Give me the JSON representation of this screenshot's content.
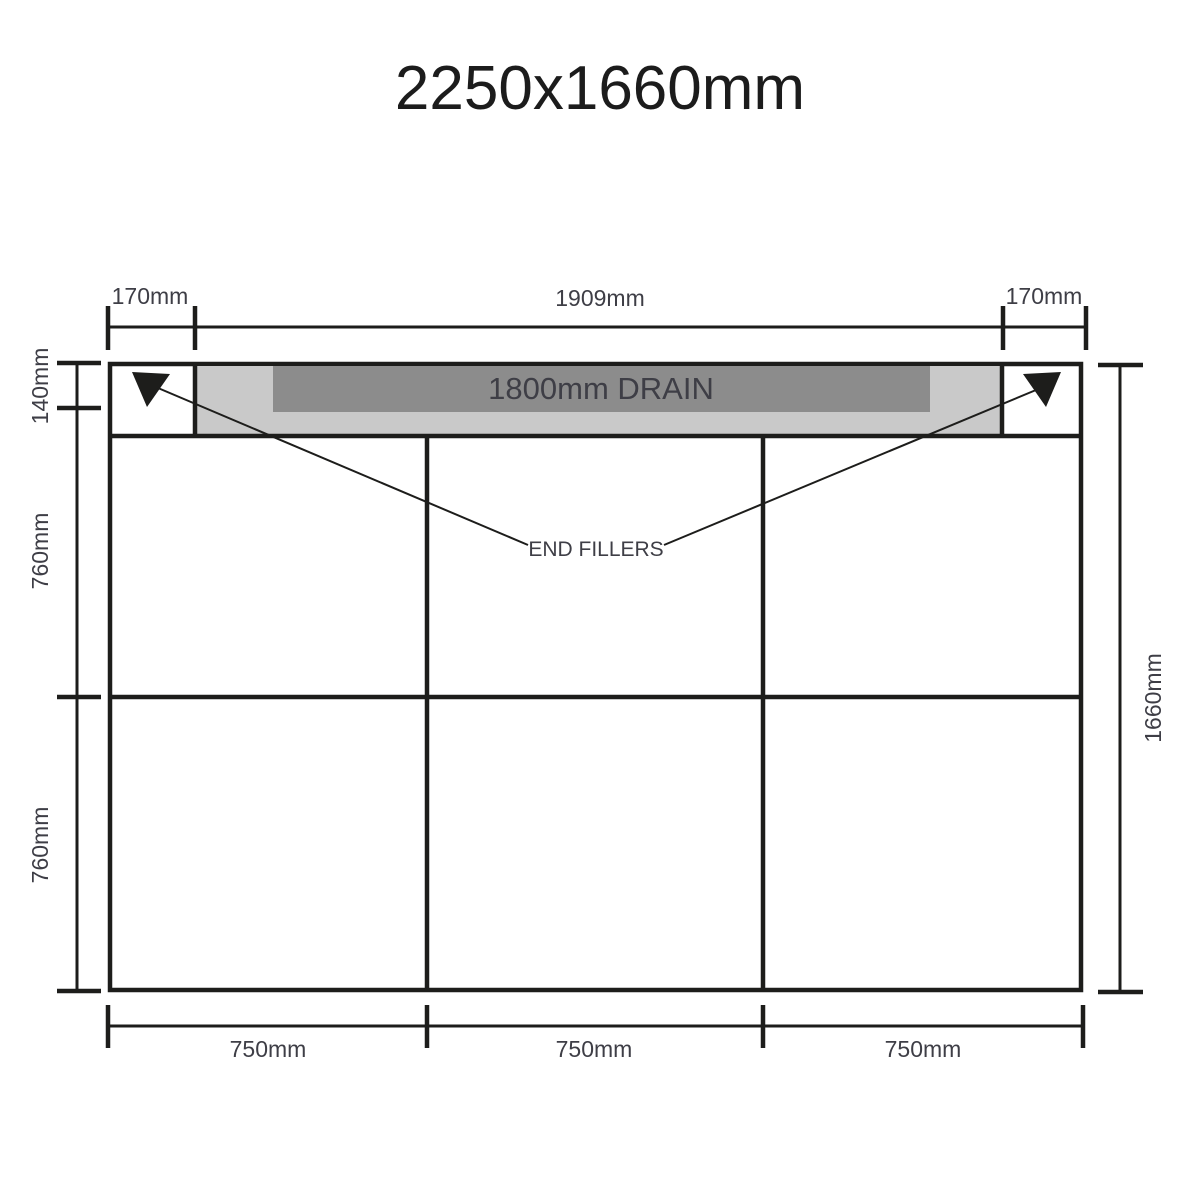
{
  "title": "2250x1660mm",
  "drain": {
    "label": "1800mm DRAIN"
  },
  "annotations": {
    "end_fillers": "END FILLERS"
  },
  "dimensions": {
    "top": {
      "left": "170mm",
      "center": "1909mm",
      "right": "170mm"
    },
    "left": {
      "top": "140mm",
      "middle": "760mm",
      "bottom": "760mm"
    },
    "right": {
      "full": "1660mm"
    },
    "bottom": {
      "left": "750mm",
      "center": "750mm",
      "right": "750mm"
    }
  },
  "colors": {
    "line": "#1d1d1b",
    "drain_dark": "#8c8c8c",
    "drain_light": "#c9c9c9",
    "label_text": "#3e3e46",
    "background": "#ffffff"
  }
}
